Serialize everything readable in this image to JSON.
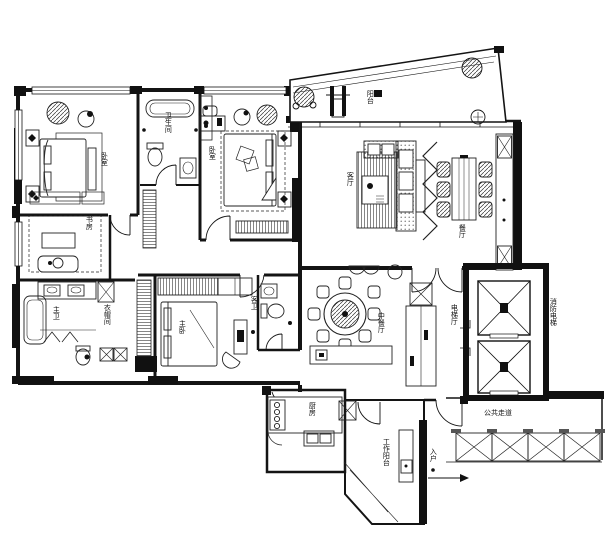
{
  "drawing": {
    "type": "apartment-floor-plan",
    "style": "black-and-white CAD line drawing"
  },
  "colors": {
    "background": "#ffffff",
    "line": "#1c1c1c",
    "wall_fill": "#111111"
  },
  "rooms": {
    "bedroom_top_left": {
      "label": "卧室"
    },
    "bathroom_top": {
      "label": "卫生间"
    },
    "bedroom_top_center": {
      "label": "卧室"
    },
    "balcony": {
      "label": "阳台"
    },
    "living_room": {
      "label": "客厅"
    },
    "dining_room": {
      "label": "餐厅"
    },
    "study": {
      "label": "书房"
    },
    "master_bathroom": {
      "label": "主卫"
    },
    "cloakroom": {
      "label": "衣帽间"
    },
    "master_bedroom": {
      "label": "主卧"
    },
    "guest_bathroom": {
      "label": "客卫"
    },
    "chinese_dining": {
      "label": "中餐厅"
    },
    "kitchen": {
      "label": "厨房"
    },
    "utility_balcony": {
      "label": "工作阳台"
    },
    "entry": {
      "label": "入户"
    },
    "public_corridor": {
      "label": "公共走道"
    },
    "elevator_hall": {
      "label": "电梯厅"
    },
    "fire_elevator": {
      "label": "消防电梯"
    }
  }
}
